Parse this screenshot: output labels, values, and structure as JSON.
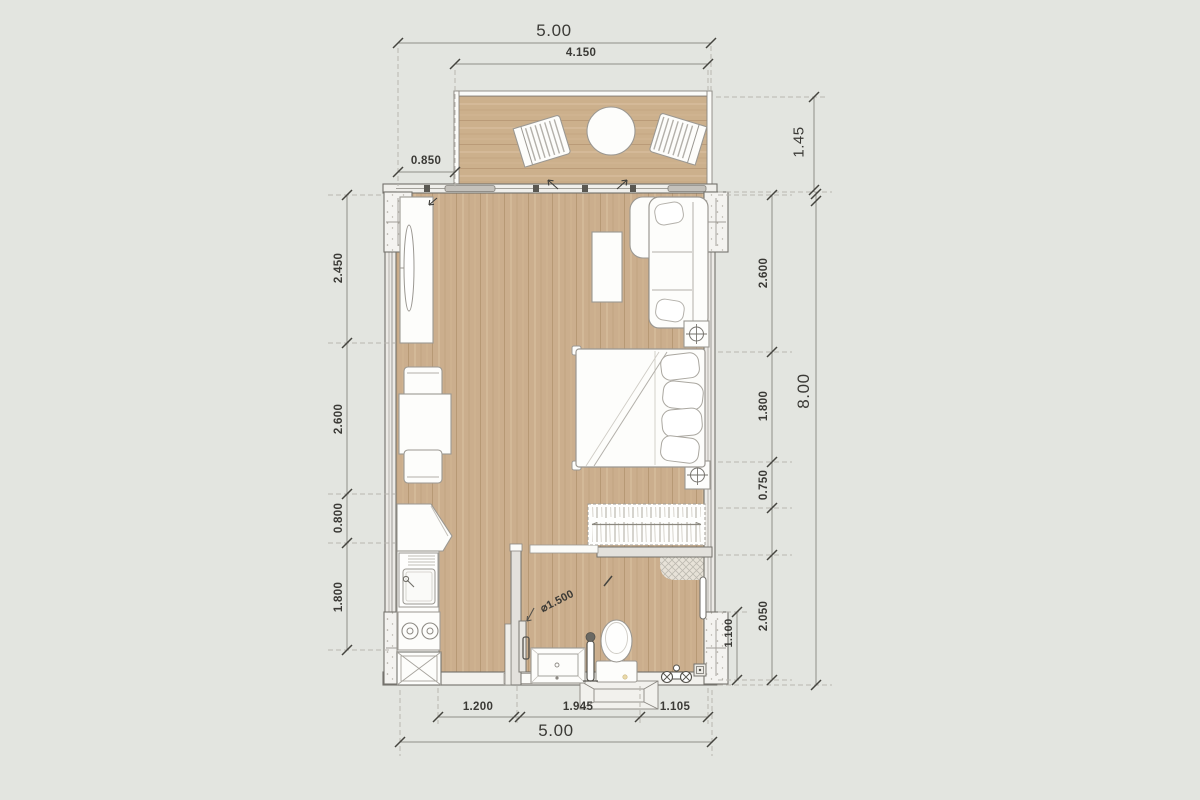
{
  "meta": {
    "drawing_type": "studio apartment floor plan, top view"
  },
  "colors": {
    "background": "#e3e5e0",
    "floor_wood": "#cbae8d",
    "balcony_wood": "#ccb08c",
    "wall_outline": "#6f6d68",
    "furniture_outline": "#9b9892",
    "dimension_text": "#3b3a36"
  },
  "dims": {
    "top_total": "5.00",
    "top_balcony": "4.150",
    "top_left_offset": "0.850",
    "balcony_depth": "1.45",
    "left": [
      "2.450",
      "2.600",
      "0.800",
      "1.800"
    ],
    "right": [
      "2.600",
      "1.800",
      "0.750",
      "2.050"
    ],
    "right_inner": "1.100",
    "right_total": "8.00",
    "bottom": [
      "1.200",
      "1.945",
      "1.105"
    ],
    "bottom_total": "5.00",
    "shower_diameter": "⌀1.500"
  }
}
